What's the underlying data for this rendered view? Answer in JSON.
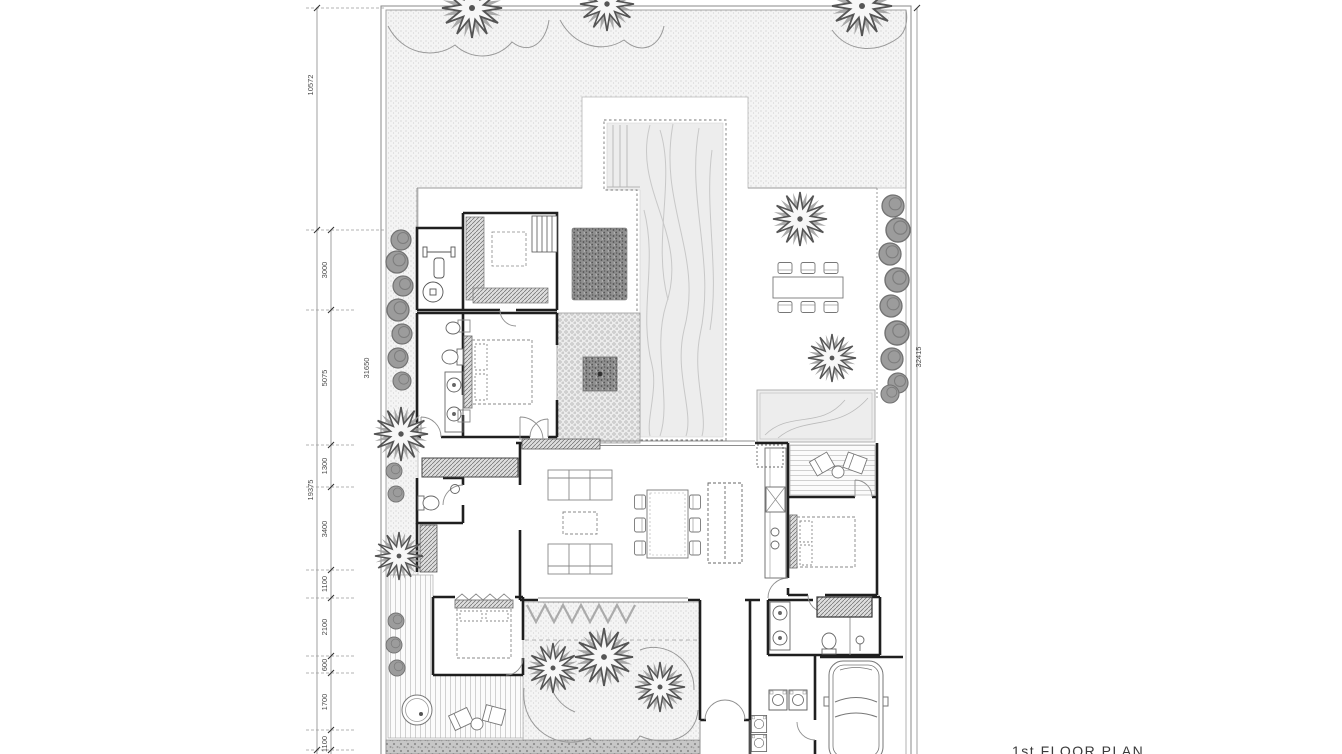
{
  "drawing": {
    "title_label": "1st FLOOR PLAN",
    "dims_segments": [
      "3000",
      "5075",
      "1300",
      "3400",
      "1100",
      "2100",
      "600",
      "1700",
      "1100"
    ],
    "dims_outer": {
      "top": "10572",
      "mid": "19375"
    },
    "dims_total_left": "31650",
    "dims_total_right": "32415",
    "palette": {
      "paper": "#ffffff",
      "wall_ink": "#1f1f1f",
      "line_ink": "#777777",
      "water": "#ededed",
      "foliage": "#9b9b9b",
      "garden_dot": "#c9c9c9",
      "paving": "#c7c7c7"
    }
  }
}
